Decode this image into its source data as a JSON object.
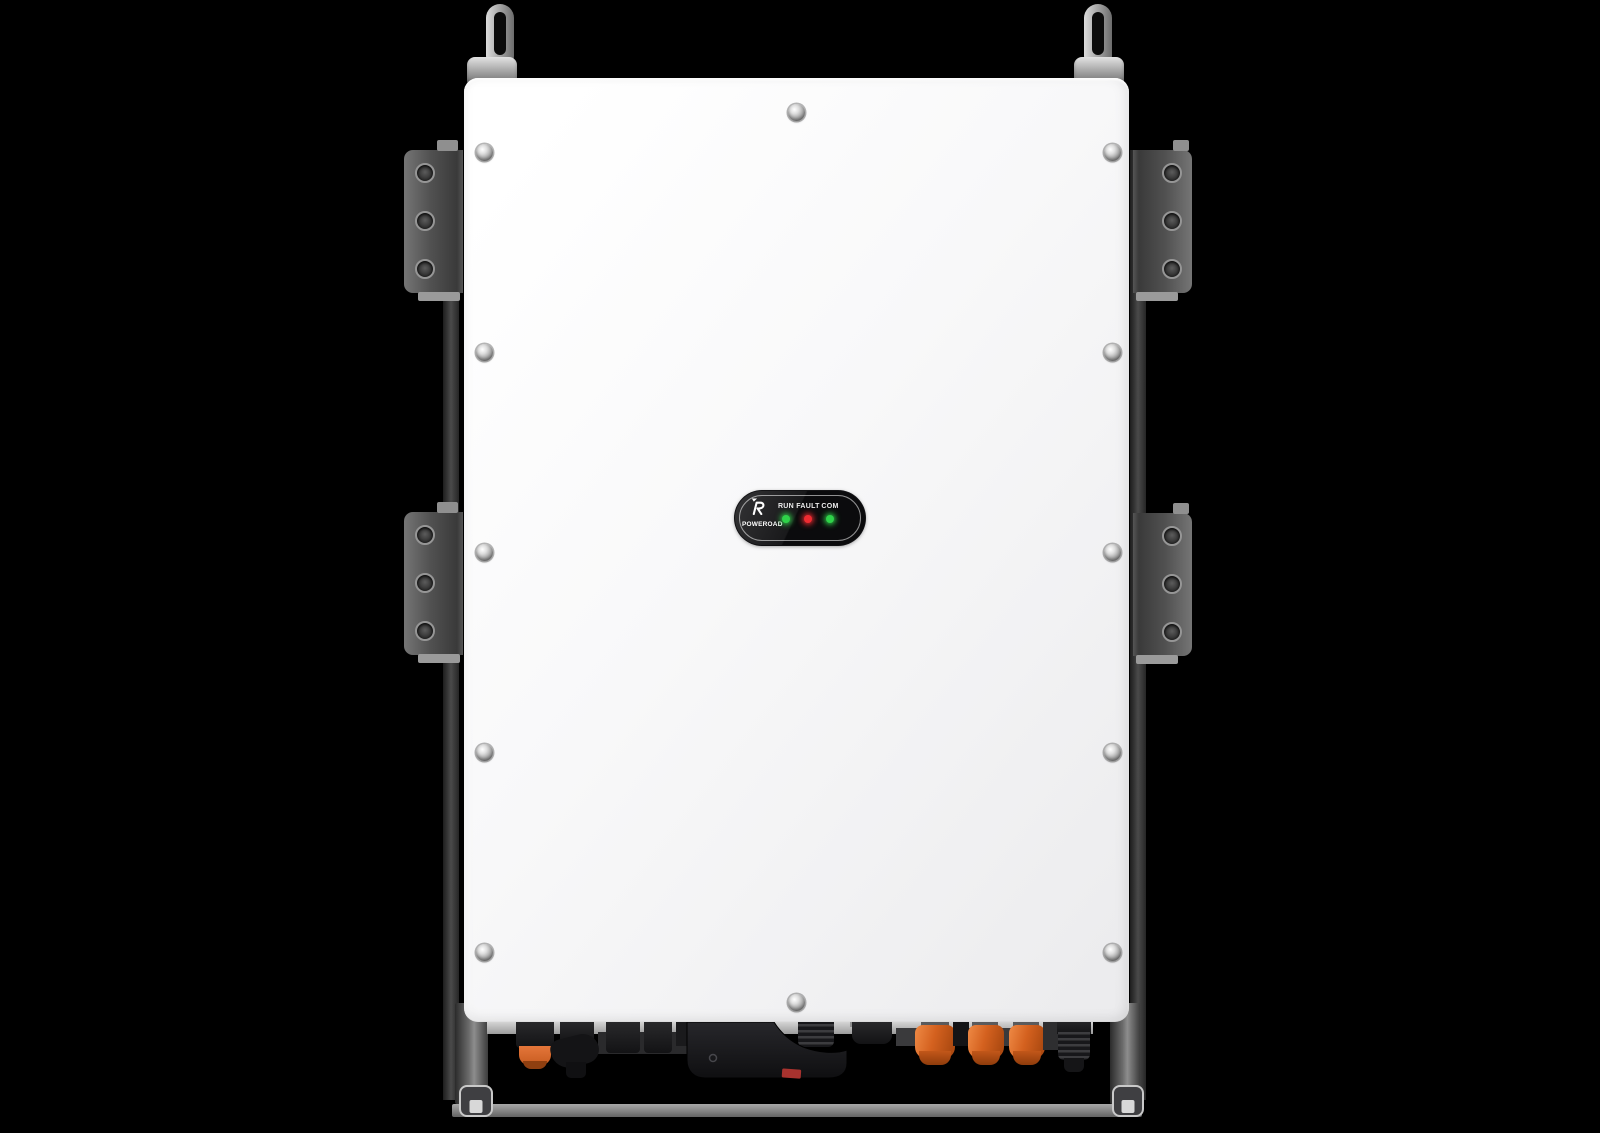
{
  "product": {
    "brand": "POWEROAD",
    "indicator_panel": {
      "leds": [
        {
          "label": "RUN",
          "color": "#2fd249",
          "state": "on"
        },
        {
          "label": "FAULT",
          "color": "#ef2b31",
          "state": "on"
        },
        {
          "label": "COM",
          "color": "#2fd249",
          "state": "on"
        }
      ]
    }
  },
  "colors": {
    "background": "#000000",
    "enclosure_white": "#f7f7f8",
    "bracket_gray": "#4d4d4d",
    "indicator_panel_black": "#0b0b0d",
    "connector_orange": "#d4611f",
    "cable_red_stripe": "#a8322e",
    "led_green": "#2fd249",
    "led_red": "#ef2b31"
  }
}
